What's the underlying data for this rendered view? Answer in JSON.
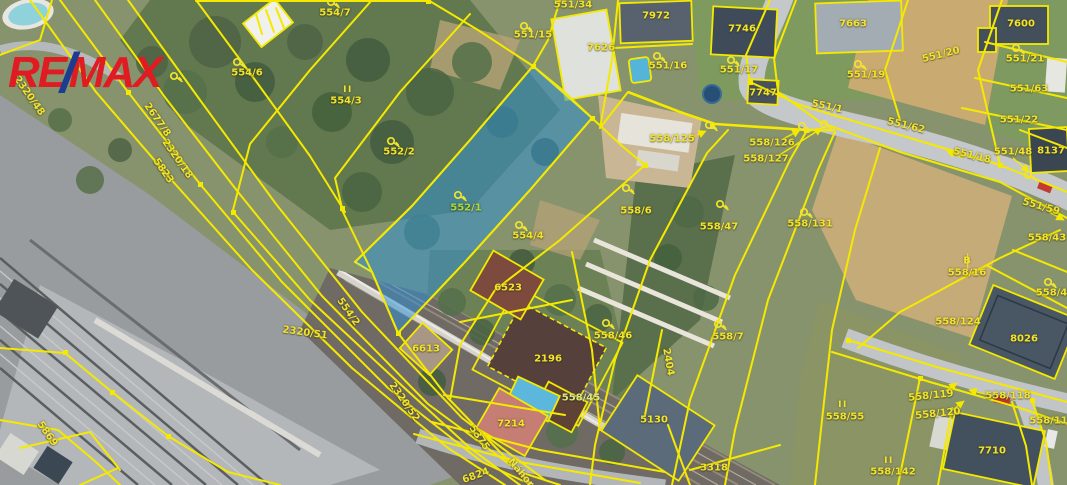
{
  "branding": {
    "logo_re": "RE",
    "logo_slash": "/",
    "logo_max": "MAX",
    "logo_red": "#e01b22",
    "logo_blue": "#1c3d8f"
  },
  "map": {
    "highlighted_parcel": "552/1",
    "highlight_color": "#2e8fd4",
    "line_color": "#f5e900",
    "label_color": "#f2e42e",
    "street_name": "Náhorní",
    "labels": [
      {
        "t": "554/7",
        "x": 335,
        "y": 13,
        "r": 0,
        "k": "parcel"
      },
      {
        "t": "554/6",
        "x": 247,
        "y": 73,
        "r": 0,
        "k": "parcel"
      },
      {
        "t": "554/3",
        "x": 346,
        "y": 101,
        "r": 0,
        "k": "parcel"
      },
      {
        "t": "552/2",
        "x": 399,
        "y": 152,
        "r": 0,
        "k": "parcel"
      },
      {
        "t": "552/1",
        "x": 466,
        "y": 208,
        "r": 0,
        "k": "highlight"
      },
      {
        "t": "554/4",
        "x": 528,
        "y": 236,
        "r": 0,
        "k": "parcel"
      },
      {
        "t": "554/2",
        "x": 348,
        "y": 312,
        "r": 55,
        "k": "parcel"
      },
      {
        "t": "551/34",
        "x": 573,
        "y": 5,
        "r": 0,
        "k": "parcel"
      },
      {
        "t": "551/15",
        "x": 533,
        "y": 35,
        "r": 0,
        "k": "parcel"
      },
      {
        "t": "7626",
        "x": 601,
        "y": 48,
        "r": 0,
        "k": "building"
      },
      {
        "t": "7972",
        "x": 656,
        "y": 16,
        "r": 0,
        "k": "building"
      },
      {
        "t": "551/16",
        "x": 668,
        "y": 66,
        "r": 0,
        "k": "parcel"
      },
      {
        "t": "7746",
        "x": 742,
        "y": 29,
        "r": 0,
        "k": "building"
      },
      {
        "t": "551/17",
        "x": 739,
        "y": 70,
        "r": 0,
        "k": "parcel"
      },
      {
        "t": "7747",
        "x": 763,
        "y": 93,
        "r": 0,
        "k": "building"
      },
      {
        "t": "7663",
        "x": 853,
        "y": 24,
        "r": 0,
        "k": "building"
      },
      {
        "t": "551/19",
        "x": 866,
        "y": 75,
        "r": 0,
        "k": "parcel"
      },
      {
        "t": "551/20",
        "x": 941,
        "y": 55,
        "r": -14,
        "k": "parcel"
      },
      {
        "t": "7600",
        "x": 1021,
        "y": 24,
        "r": 0,
        "k": "building"
      },
      {
        "t": "551/21",
        "x": 1025,
        "y": 59,
        "r": 0,
        "k": "parcel"
      },
      {
        "t": "551/63",
        "x": 1029,
        "y": 89,
        "r": 0,
        "k": "parcel"
      },
      {
        "t": "551/22",
        "x": 1019,
        "y": 120,
        "r": 0,
        "k": "parcel"
      },
      {
        "t": "8137",
        "x": 1051,
        "y": 151,
        "r": 0,
        "k": "building"
      },
      {
        "t": "551/48",
        "x": 1013,
        "y": 152,
        "r": 0,
        "k": "parcel"
      },
      {
        "t": "551/18",
        "x": 972,
        "y": 156,
        "r": 14,
        "k": "road"
      },
      {
        "t": "551/1",
        "x": 827,
        "y": 107,
        "r": 12,
        "k": "road"
      },
      {
        "t": "551/62",
        "x": 906,
        "y": 126,
        "r": 14,
        "k": "road"
      },
      {
        "t": "551/59",
        "x": 1041,
        "y": 207,
        "r": 16,
        "k": "road"
      },
      {
        "t": "558/125",
        "x": 672,
        "y": 139,
        "r": 0,
        "k": "parcel"
      },
      {
        "t": "558/126",
        "x": 772,
        "y": 143,
        "r": 0,
        "k": "parcel"
      },
      {
        "t": "558/127",
        "x": 766,
        "y": 159,
        "r": 0,
        "k": "parcel"
      },
      {
        "t": "558/6",
        "x": 636,
        "y": 211,
        "r": 0,
        "k": "parcel"
      },
      {
        "t": "558/47",
        "x": 719,
        "y": 227,
        "r": 0,
        "k": "parcel"
      },
      {
        "t": "558/131",
        "x": 810,
        "y": 224,
        "r": 0,
        "k": "parcel"
      },
      {
        "t": "558/7",
        "x": 728,
        "y": 337,
        "r": 0,
        "k": "parcel"
      },
      {
        "t": "558/16",
        "x": 967,
        "y": 273,
        "r": 0,
        "k": "parcel"
      },
      {
        "t": "558/43",
        "x": 1047,
        "y": 238,
        "r": 0,
        "k": "parcel"
      },
      {
        "t": "558/48",
        "x": 1055,
        "y": 293,
        "r": 0,
        "k": "parcel"
      },
      {
        "t": "558/124",
        "x": 958,
        "y": 322,
        "r": 0,
        "k": "parcel"
      },
      {
        "t": "8026",
        "x": 1024,
        "y": 339,
        "r": 0,
        "k": "building"
      },
      {
        "t": "558/119",
        "x": 931,
        "y": 396,
        "r": -6,
        "k": "parcel"
      },
      {
        "t": "558/118",
        "x": 1008,
        "y": 396,
        "r": 0,
        "k": "parcel"
      },
      {
        "t": "558/120",
        "x": 938,
        "y": 414,
        "r": -6,
        "k": "parcel"
      },
      {
        "t": "558/117",
        "x": 1052,
        "y": 421,
        "r": 0,
        "k": "parcel"
      },
      {
        "t": "7710",
        "x": 992,
        "y": 451,
        "r": 0,
        "k": "building"
      },
      {
        "t": "558/142",
        "x": 893,
        "y": 472,
        "r": 0,
        "k": "parcel"
      },
      {
        "t": "558/55",
        "x": 845,
        "y": 417,
        "r": 0,
        "k": "parcel"
      },
      {
        "t": "2196",
        "x": 548,
        "y": 359,
        "r": 0,
        "k": "building"
      },
      {
        "t": "558/46",
        "x": 613,
        "y": 336,
        "r": 0,
        "k": "parcel"
      },
      {
        "t": "558/45",
        "x": 581,
        "y": 398,
        "r": 0,
        "k": "pool"
      },
      {
        "t": "7214",
        "x": 511,
        "y": 424,
        "r": 0,
        "k": "building"
      },
      {
        "t": "5130",
        "x": 654,
        "y": 420,
        "r": 0,
        "k": "building"
      },
      {
        "t": "3318",
        "x": 714,
        "y": 468,
        "r": 0,
        "k": "parcel"
      },
      {
        "t": "6613",
        "x": 426,
        "y": 349,
        "r": 0,
        "k": "building"
      },
      {
        "t": "6523",
        "x": 508,
        "y": 288,
        "r": 0,
        "k": "building"
      },
      {
        "t": "2404",
        "x": 668,
        "y": 362,
        "r": 80,
        "k": "parcel"
      },
      {
        "t": "2320/51",
        "x": 305,
        "y": 333,
        "r": 8,
        "k": "parcel"
      },
      {
        "t": "2320/52",
        "x": 404,
        "y": 402,
        "r": 55,
        "k": "parcel"
      },
      {
        "t": "5375",
        "x": 479,
        "y": 438,
        "r": 55,
        "k": "parcel"
      },
      {
        "t": "6824",
        "x": 476,
        "y": 476,
        "r": -20,
        "k": "parcel"
      },
      {
        "t": "Náhorní",
        "x": 524,
        "y": 477,
        "r": 50,
        "k": "street"
      },
      {
        "t": "2320/48",
        "x": 29,
        "y": 96,
        "r": 55,
        "k": "parcel"
      },
      {
        "t": "2677/8",
        "x": 157,
        "y": 120,
        "r": 55,
        "k": "parcel"
      },
      {
        "t": "2320/18",
        "x": 177,
        "y": 159,
        "r": 55,
        "k": "parcel"
      },
      {
        "t": "5823",
        "x": 163,
        "y": 171,
        "r": 55,
        "k": "parcel"
      },
      {
        "t": "5869",
        "x": 47,
        "y": 434,
        "r": 55,
        "k": "parcel"
      }
    ],
    "symbols": [
      {
        "t": "key",
        "x": 334,
        "y": 3
      },
      {
        "t": "key",
        "x": 240,
        "y": 63
      },
      {
        "t": "bars",
        "x": 348,
        "y": 90
      },
      {
        "t": "key",
        "x": 394,
        "y": 142
      },
      {
        "t": "key",
        "x": 461,
        "y": 196
      },
      {
        "t": "key",
        "x": 522,
        "y": 226
      },
      {
        "t": "key",
        "x": 527,
        "y": 27
      },
      {
        "t": "key",
        "x": 660,
        "y": 57
      },
      {
        "t": "key",
        "x": 734,
        "y": 61
      },
      {
        "t": "key",
        "x": 861,
        "y": 65
      },
      {
        "t": "key",
        "x": 1019,
        "y": 49
      },
      {
        "t": "key",
        "x": 177,
        "y": 77
      },
      {
        "t": "key",
        "x": 629,
        "y": 189
      },
      {
        "t": "key",
        "x": 723,
        "y": 205
      },
      {
        "t": "key",
        "x": 807,
        "y": 213
      },
      {
        "t": "key",
        "x": 721,
        "y": 325
      },
      {
        "t": "b",
        "x": 967,
        "y": 261
      },
      {
        "t": "key",
        "x": 1051,
        "y": 283
      },
      {
        "t": "key",
        "x": 609,
        "y": 324
      },
      {
        "t": "bars",
        "x": 843,
        "y": 405
      },
      {
        "t": "bars",
        "x": 889,
        "y": 461
      },
      {
        "t": "key",
        "x": 712,
        "y": 126
      },
      {
        "t": "key",
        "x": 805,
        "y": 127
      },
      {
        "t": "key",
        "x": 827,
        "y": 125
      },
      {
        "t": "key",
        "x": 1031,
        "y": 176
      }
    ]
  }
}
